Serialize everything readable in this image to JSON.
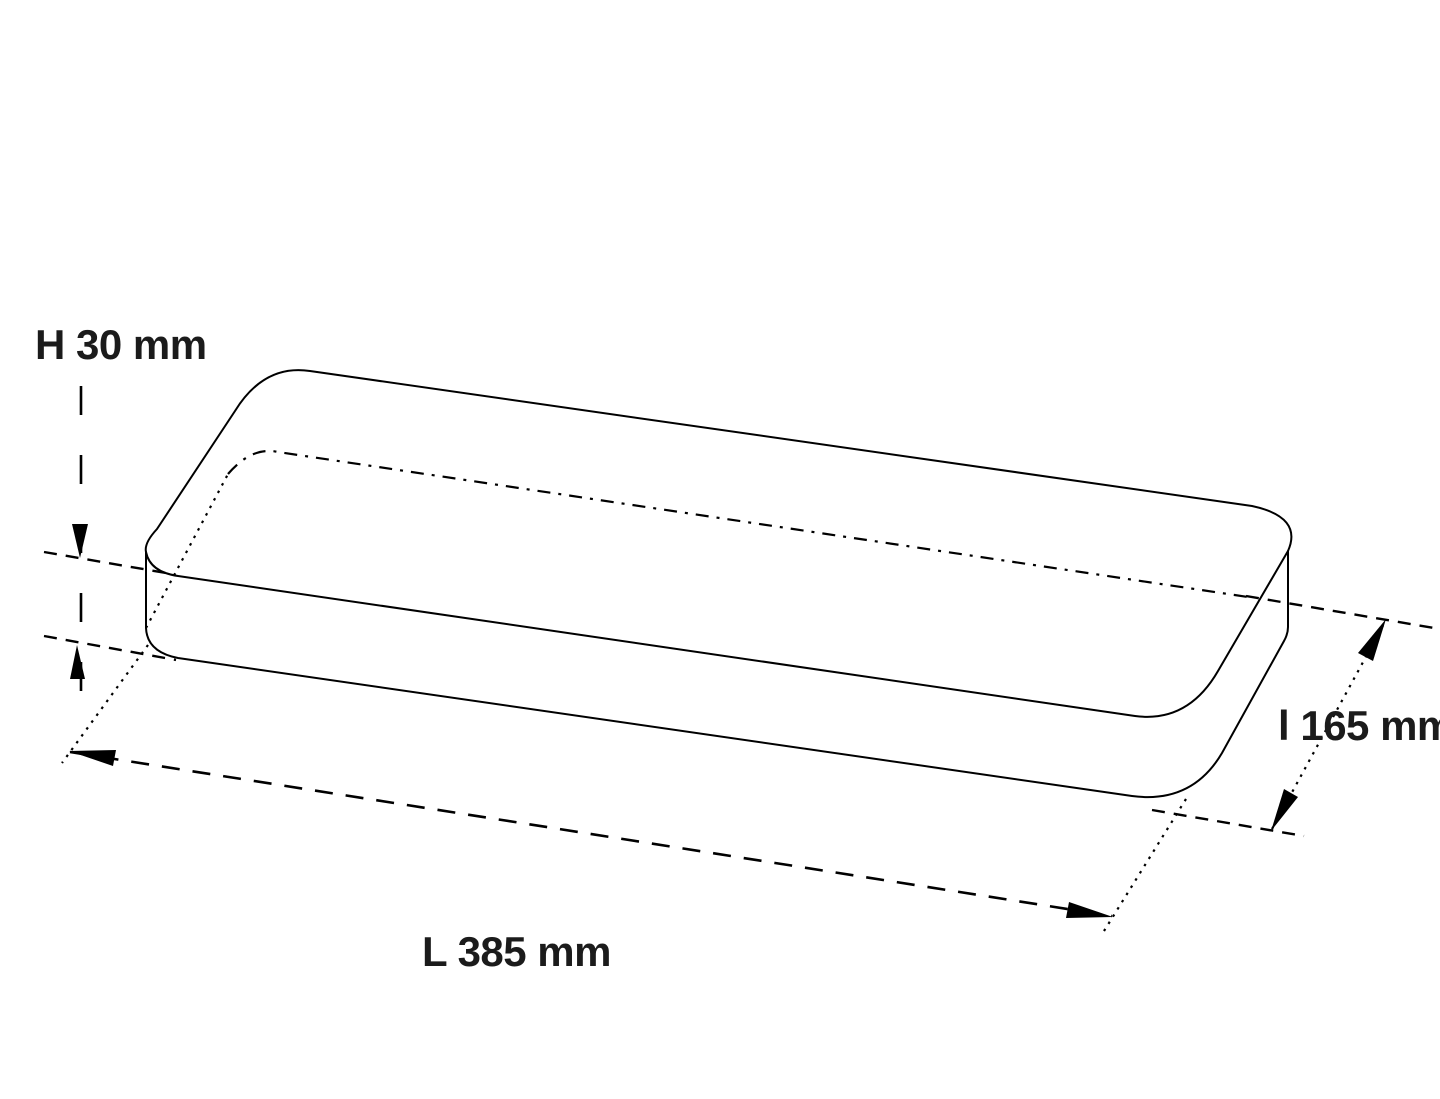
{
  "drawing": {
    "object": "rounded-rectangular-slab",
    "view": "perspective-dimension-drawing",
    "labels": {
      "height": "H 30 mm",
      "length": "L 385 mm",
      "width": "l 165 mm"
    },
    "values": {
      "height_mm": 30,
      "length_mm": 385,
      "width_mm": 165,
      "unit": "mm"
    },
    "colors": {
      "background": "#ffffff",
      "line": "#000000",
      "text": "#1b1b1b"
    }
  }
}
